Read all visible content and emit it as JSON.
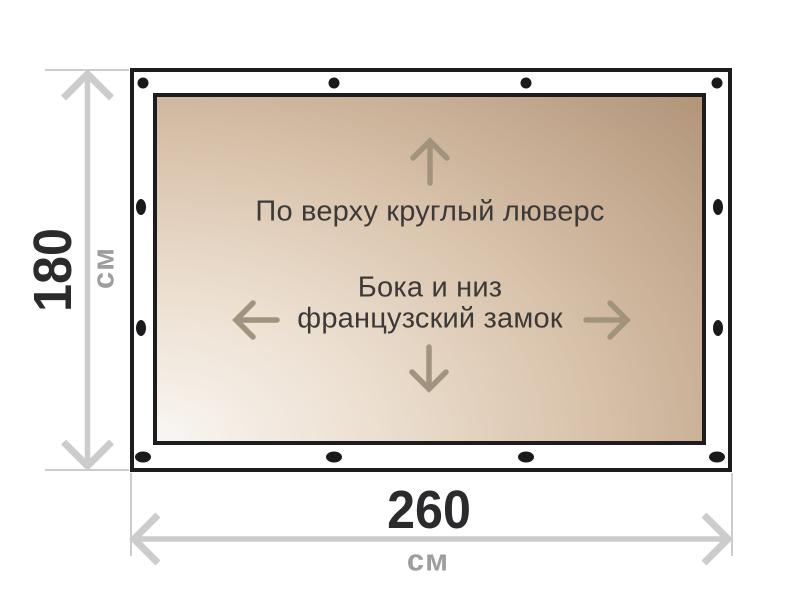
{
  "colors": {
    "ink": "#1d1d1f",
    "grommet": "#1a1a1c",
    "sheet-light": "#f9f6f2",
    "sheet-mid": "#d9c3ac",
    "sheet-dark": "#b3967a",
    "dim-line": "#cccccc",
    "dim-value": "#2b2b2e",
    "dim-unit": "#9e9e9e",
    "tarp-arrow": "#a2937f",
    "tarp-text": "#3b3a38"
  },
  "tarp": {
    "labels": {
      "top_edge": "По верху круглый люверс",
      "other_edges_line1": "Бока и низ",
      "other_edges_line2": "французский замок"
    },
    "grommet_count": 12
  },
  "dimensions": {
    "height": {
      "value": "180",
      "unit": "см"
    },
    "width": {
      "value": "260",
      "unit": "см"
    }
  }
}
